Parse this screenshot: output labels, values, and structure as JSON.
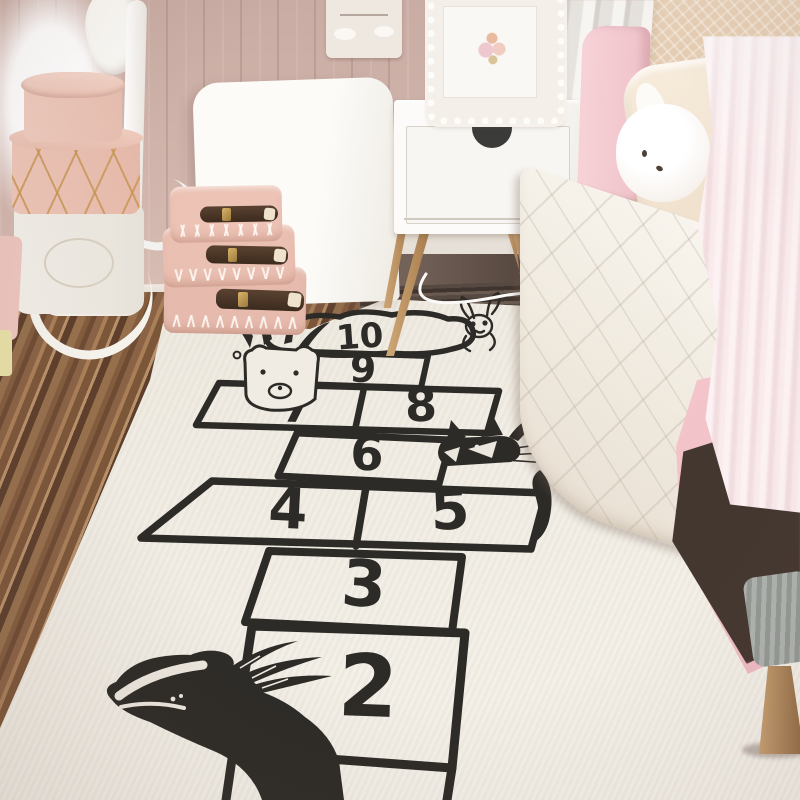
{
  "scene": {
    "type": "photograph",
    "setting": "pastel pink kids bedroom with a hand-drawn hopscotch play rug on a striped wooden floor",
    "objects": [
      "hopscotch-rug",
      "wood-plank-floor",
      "pink-panel-wall",
      "white-headboard-leaning-on-wall",
      "stacked-pink-hatboxes",
      "white-storage-basket",
      "white-clothes-rack",
      "stacked-pink-mini-suitcases",
      "white-nightstand-with-wood-legs",
      "ornate-white-picture-frame",
      "wall-plaque",
      "pink-bed-frame",
      "white-quilted-blanket",
      "beige-pillow",
      "cream-pillow",
      "bunny-plush",
      "pink-fur-throw",
      "grey-knit-blanket",
      "wooden-bed-leg",
      "grey-drape"
    ]
  },
  "rug": {
    "style": "hand-drawn black ink hopscotch court on cream rug",
    "cells": [
      {
        "id": "cell-10",
        "label": "10",
        "shape": "cloud"
      },
      {
        "id": "cell-9",
        "label": "9",
        "shape": "square"
      },
      {
        "id": "cell-7",
        "label": "7",
        "shape": "square"
      },
      {
        "id": "cell-8",
        "label": "8",
        "shape": "square"
      },
      {
        "id": "cell-6",
        "label": "6",
        "shape": "square"
      },
      {
        "id": "cell-4",
        "label": "4",
        "shape": "square"
      },
      {
        "id": "cell-5",
        "label": "5",
        "shape": "square"
      },
      {
        "id": "cell-3",
        "label": "3",
        "shape": "square"
      },
      {
        "id": "cell-2",
        "label": "2",
        "shape": "square"
      }
    ],
    "animals": [
      "raccoon-with-feather-headdress",
      "bunny-sketch",
      "fox-with-feather",
      "badger-with-feathers"
    ]
  },
  "colors": {
    "ink": "#2d2b27",
    "rug_cream": "#efeae0",
    "wall_pink_beige": "#cdb2a9",
    "wall_pink": "#e9cac5",
    "floor_dark": "#5d3f2c",
    "floor_mid": "#8a6245",
    "floor_light": "#b8906a",
    "hatbox_pink": "#ecc6b9",
    "suitcase_pink": "#e8beb0",
    "strap_leather": "#4a3527",
    "buckle_gold": "#c09355",
    "nightstand_white": "#f8f6f2",
    "leg_wood": "#c2996a",
    "bed_pink": "#f2c8cd",
    "blanket_cream": "#f5f0e8",
    "fur_pink": "#f7e6e8",
    "underbed_shadow": "#443730",
    "knit_grey": "#a8adaa"
  }
}
